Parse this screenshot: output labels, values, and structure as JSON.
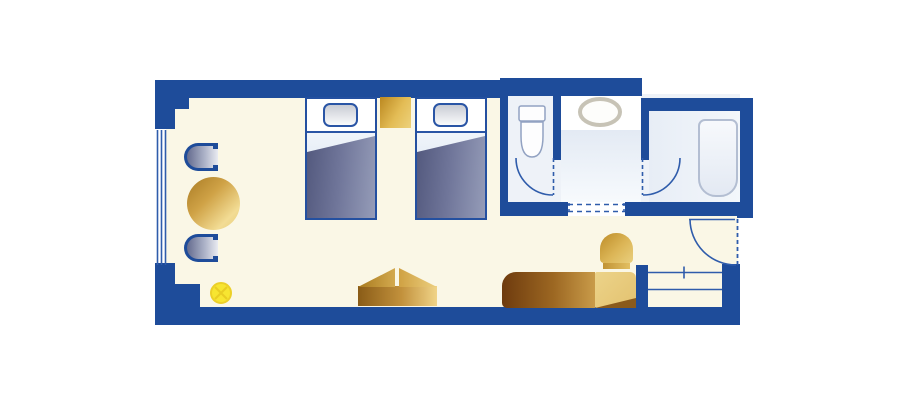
{
  "palette": {
    "wall": "#1e4c9a",
    "line": "#2f5cab",
    "floor": "#faf7e6",
    "bath_floor": "#eef2f8",
    "blanket_a": "#50567b",
    "blanket_b": "#959cb8",
    "pillow": "#c9ccd4",
    "lamp": "#f7e531",
    "lamp_edge": "#ecd028",
    "gold_dark": "#8a5c17",
    "gold_mid": "#c2913c",
    "gold_light": "#f0d488",
    "sofa_dark": "#6e3b0e",
    "fixture_stroke": "#92a2c2",
    "sink_stroke": "#c7c3b6",
    "tub_stroke": "#b3bed2"
  },
  "rooms": [
    {
      "name": "bedroom-living-area"
    },
    {
      "name": "toilet-room"
    },
    {
      "name": "vanity-room"
    },
    {
      "name": "bathtub-room"
    },
    {
      "name": "entry-hall"
    },
    {
      "name": "closet"
    }
  ],
  "furniture": [
    {
      "name": "twin-bed",
      "count": 2
    },
    {
      "name": "nightstand",
      "count": 1
    },
    {
      "name": "armchair",
      "count": 2
    },
    {
      "name": "round-table",
      "count": 1
    },
    {
      "name": "floor-lamp",
      "count": 1
    },
    {
      "name": "luggage-bench",
      "count": 1
    },
    {
      "name": "sofa",
      "count": 1
    },
    {
      "name": "side-chair",
      "count": 1
    },
    {
      "name": "toilet",
      "count": 1
    },
    {
      "name": "sink",
      "count": 1
    },
    {
      "name": "bathtub",
      "count": 1
    }
  ]
}
